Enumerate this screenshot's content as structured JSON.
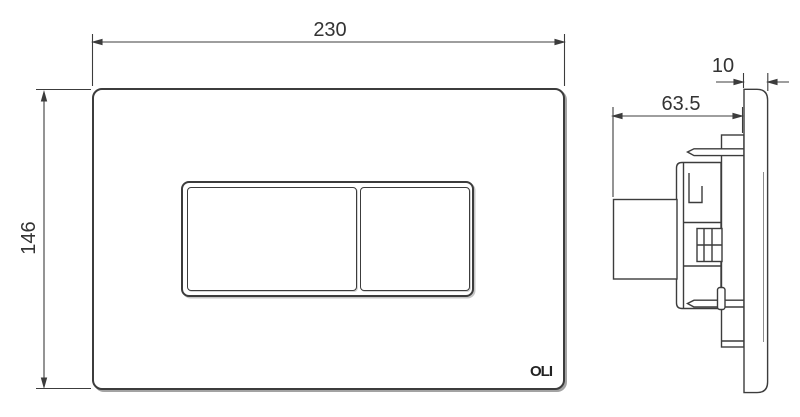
{
  "front_view": {
    "width_dim": "230",
    "height_dim": "146",
    "logo": "OLI"
  },
  "side_view": {
    "depth_dim": "63.5",
    "thickness_dim": "10"
  },
  "colors": {
    "line": "#3c3c3c",
    "background": "#ffffff",
    "dim_text": "#333333",
    "shadow": "#8c8c8c"
  }
}
